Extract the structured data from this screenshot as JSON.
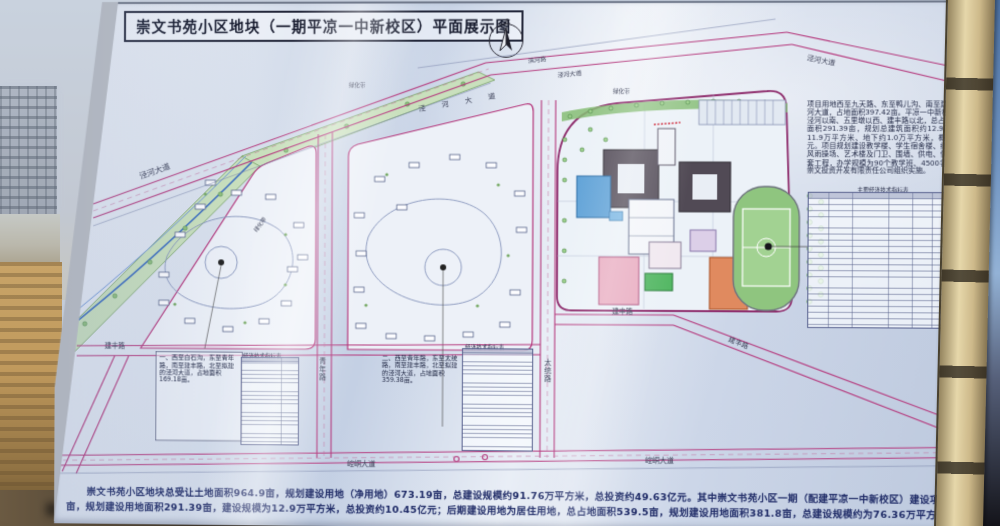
{
  "photo": {
    "board": {
      "title": "崇文书苑小区地块（一期平凉一中新校区）平面展示图",
      "north_label": "北",
      "map": {
        "road_labels": {
          "binhe_top": "滨河路",
          "jinghe_nw": "泾河大道",
          "jinghe_mid": "泾 河 大 道",
          "jinghe_top": "泾河大道",
          "jinghe_ne": "泾河大道",
          "greenbelt_1": "绿化带",
          "greenbelt_2": "绿化带",
          "greenbelt_3": "绿化带",
          "qingnian": "青年路",
          "taitong": "太统路",
          "jianfeng_w": "建丰路",
          "jianfeng_mid": "建丰路",
          "jianfeng_diag": "建丰路",
          "kongtong_1": "崆峒大道",
          "kongtong_2": "崆峒大道"
        },
        "notes": {
          "note1": "一、西至白石沟，东至青年路，南至建丰路，北至拟建的泾河大道，占地面积169.18亩。",
          "note2": "二、西至青年路，东至太统路，南至建丰路，北至拟建的泾河大道，占地面积359.38亩。"
        },
        "table1_title": "经济技术指标表",
        "table2_title": "经济技术指标表"
      },
      "right_panel": {
        "paragraph": "项目用地西至九天路、东至鸭儿沟、南至建丰路、北至规划的泾河大道，占地面积397.42亩。平凉一中新校区位于九天路以东、泾河以南、五里墩以西、建丰路以北，总占地397.42亩，净用地面积291.39亩，规划总建筑面积约12.9万平方米，其中地上11.9万平方米、地下约1.0万平方米，概算总投资约10.45亿元。项目规划建设教学楼、学生宿舍楼、综合服务中心、食堂、风雨操场、艺术楼及门卫、围墙、供电、供暖、道路、绿化等配套工程，办学规模为90个教学班、4500名学生。项目由平凉市崇文投资开发有限责任公司组织实施。",
        "table_title": "主要经济技术指标表"
      },
      "summary": {
        "line1": "崇文书苑小区地块总受让土地面积964.9亩，规划建设用地（净用地）673.19亩，总建设规模约91.76万平方米，总投资约49.63亿元。其中崇文书苑小区一期（配建平凉一中新校区）建设项目，总占地面积397.42",
        "line2": "亩，规划建设用地面积291.39亩，建设规模为12.9万平方米，总投资约10.45亿元；后期建设用地为居住用地，总占地面积539.5亩，规划建设用地面积381.8亩，总建设规模约为76.36万平方米，计划投资39.41亿元。"
      },
      "colors": {
        "road": "#b5397d",
        "board_tint": "#cfd9ea",
        "summary_text": "#1e2a66",
        "greenbelt": "#c9e0bd"
      }
    }
  }
}
